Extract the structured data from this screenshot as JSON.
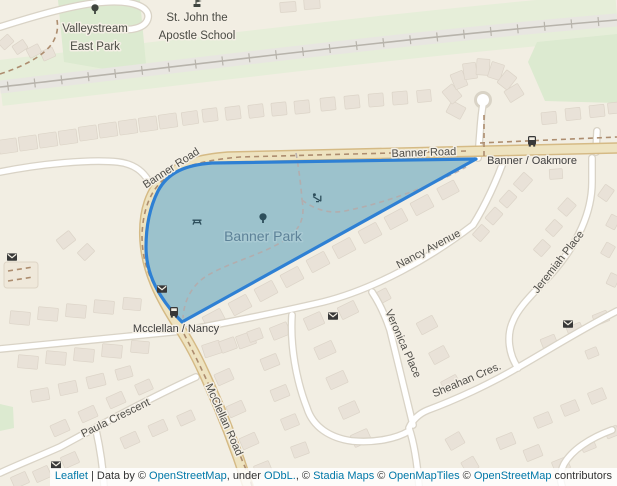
{
  "map": {
    "colors": {
      "land": "#f2eee3",
      "building": "#e9e2d8",
      "building_line": "#dcd4c8",
      "green": "#dcead0",
      "green_light": "#e6eed9",
      "rail_bed": "#e8e6e1",
      "rail_line": "#b7b3ab",
      "road_white": "#ffffff",
      "road_casing": "#d9d3c6",
      "tan": "#eee3c0",
      "tan_casing": "#d5ba85",
      "dash": "#ad8d6f",
      "park_fill": "#9cc2cc",
      "park_stroke": "#2e80d4",
      "park_label": "#5d8298",
      "label": "#4f4e49",
      "poi_label": "#4a4b44",
      "stop_label": "#3e3e3e",
      "icon": "#3f453f",
      "icon_park": "#2e4f5c",
      "icon_dark": "#383838",
      "link": "#0078a8",
      "attr_text": "#333333"
    },
    "labels": [
      {
        "name": "valleystream-east-park",
        "lines": [
          "Valleystream",
          "East Park"
        ],
        "x": 95,
        "y": 32,
        "rotate": 0,
        "cls": "poi"
      },
      {
        "name": "st-john-apostle-school",
        "lines": [
          "St. John the",
          "Apostle School"
        ],
        "x": 197,
        "y": 21,
        "rotate": 0,
        "cls": "poi"
      },
      {
        "name": "banner-road-west",
        "lines": [
          "Banner Road"
        ],
        "x": 173,
        "y": 171,
        "rotate": -33,
        "cls": "road"
      },
      {
        "name": "banner-road-east",
        "lines": [
          "Banner Road"
        ],
        "x": 424,
        "y": 156,
        "rotate": -2,
        "cls": "road"
      },
      {
        "name": "banner-oakmore-stop",
        "lines": [
          "Banner / Oakmore"
        ],
        "x": 532,
        "y": 164,
        "rotate": 0,
        "cls": "stop"
      },
      {
        "name": "banner-park",
        "lines": [
          "Banner Park"
        ],
        "x": 263,
        "y": 241,
        "rotate": 0,
        "cls": "park"
      },
      {
        "name": "nancy-avenue",
        "lines": [
          "Nancy Avenue"
        ],
        "x": 430,
        "y": 252,
        "rotate": -28,
        "cls": "road"
      },
      {
        "name": "jeremiah-place",
        "lines": [
          "Jeremiah Place"
        ],
        "x": 561,
        "y": 264,
        "rotate": -52,
        "cls": "road"
      },
      {
        "name": "veronica-place",
        "lines": [
          "Veronica Place"
        ],
        "x": 400,
        "y": 345,
        "rotate": 66,
        "cls": "road"
      },
      {
        "name": "sheahan-cres",
        "lines": [
          "Sheahan Cres."
        ],
        "x": 468,
        "y": 383,
        "rotate": -23,
        "cls": "road"
      },
      {
        "name": "mcclellan-nancy-stop",
        "lines": [
          "Mcclellan / Nancy"
        ],
        "x": 176,
        "y": 332,
        "rotate": 0,
        "cls": "stop"
      },
      {
        "name": "mcclellan-road",
        "lines": [
          "McClellan Road"
        ],
        "x": 221,
        "y": 421,
        "rotate": 66,
        "cls": "road"
      },
      {
        "name": "paula-crescent",
        "lines": [
          "Paula Crescent"
        ],
        "x": 117,
        "y": 421,
        "rotate": -26,
        "cls": "road"
      }
    ],
    "icons": [
      {
        "type": "tree",
        "x": 95,
        "y": 11,
        "variant": "land"
      },
      {
        "type": "school",
        "x": 197,
        "y": 4,
        "variant": "land"
      },
      {
        "type": "tree",
        "x": 263,
        "y": 220,
        "variant": "park"
      },
      {
        "type": "picnic",
        "x": 197,
        "y": 221,
        "variant": "park"
      },
      {
        "type": "playground",
        "x": 317,
        "y": 198,
        "variant": "park"
      },
      {
        "type": "bus",
        "x": 532,
        "y": 141,
        "variant": "dark"
      },
      {
        "type": "bus",
        "x": 174,
        "y": 312,
        "variant": "dark"
      },
      {
        "type": "mail",
        "x": 162,
        "y": 289,
        "variant": "dark"
      },
      {
        "type": "mail",
        "x": 12,
        "y": 257,
        "variant": "dark"
      },
      {
        "type": "mail",
        "x": 333,
        "y": 316,
        "variant": "dark"
      },
      {
        "type": "mail",
        "x": 568,
        "y": 324,
        "variant": "dark"
      },
      {
        "type": "mail",
        "x": 56,
        "y": 465,
        "variant": "dark"
      }
    ],
    "attribution": [
      {
        "text": "Leaflet",
        "link": true,
        "name": "leaflet-link"
      },
      {
        "text": " | Data by © ",
        "link": false,
        "name": "attr-text"
      },
      {
        "text": "OpenStreetMap",
        "link": true,
        "name": "openstreetmap-link"
      },
      {
        "text": ", under ",
        "link": false,
        "name": "attr-text"
      },
      {
        "text": "ODbL.",
        "link": true,
        "name": "odbl-link"
      },
      {
        "text": ", © ",
        "link": false,
        "name": "attr-text"
      },
      {
        "text": "Stadia Maps",
        "link": true,
        "name": "stadia-maps-link"
      },
      {
        "text": " © ",
        "link": false,
        "name": "attr-text"
      },
      {
        "text": "OpenMapTiles",
        "link": true,
        "name": "openmaptiles-link"
      },
      {
        "text": " © ",
        "link": false,
        "name": "attr-text"
      },
      {
        "text": "OpenStreetMap",
        "link": true,
        "name": "openstreetmap-link-2"
      },
      {
        "text": " contributors",
        "link": false,
        "name": "attr-text"
      }
    ]
  }
}
